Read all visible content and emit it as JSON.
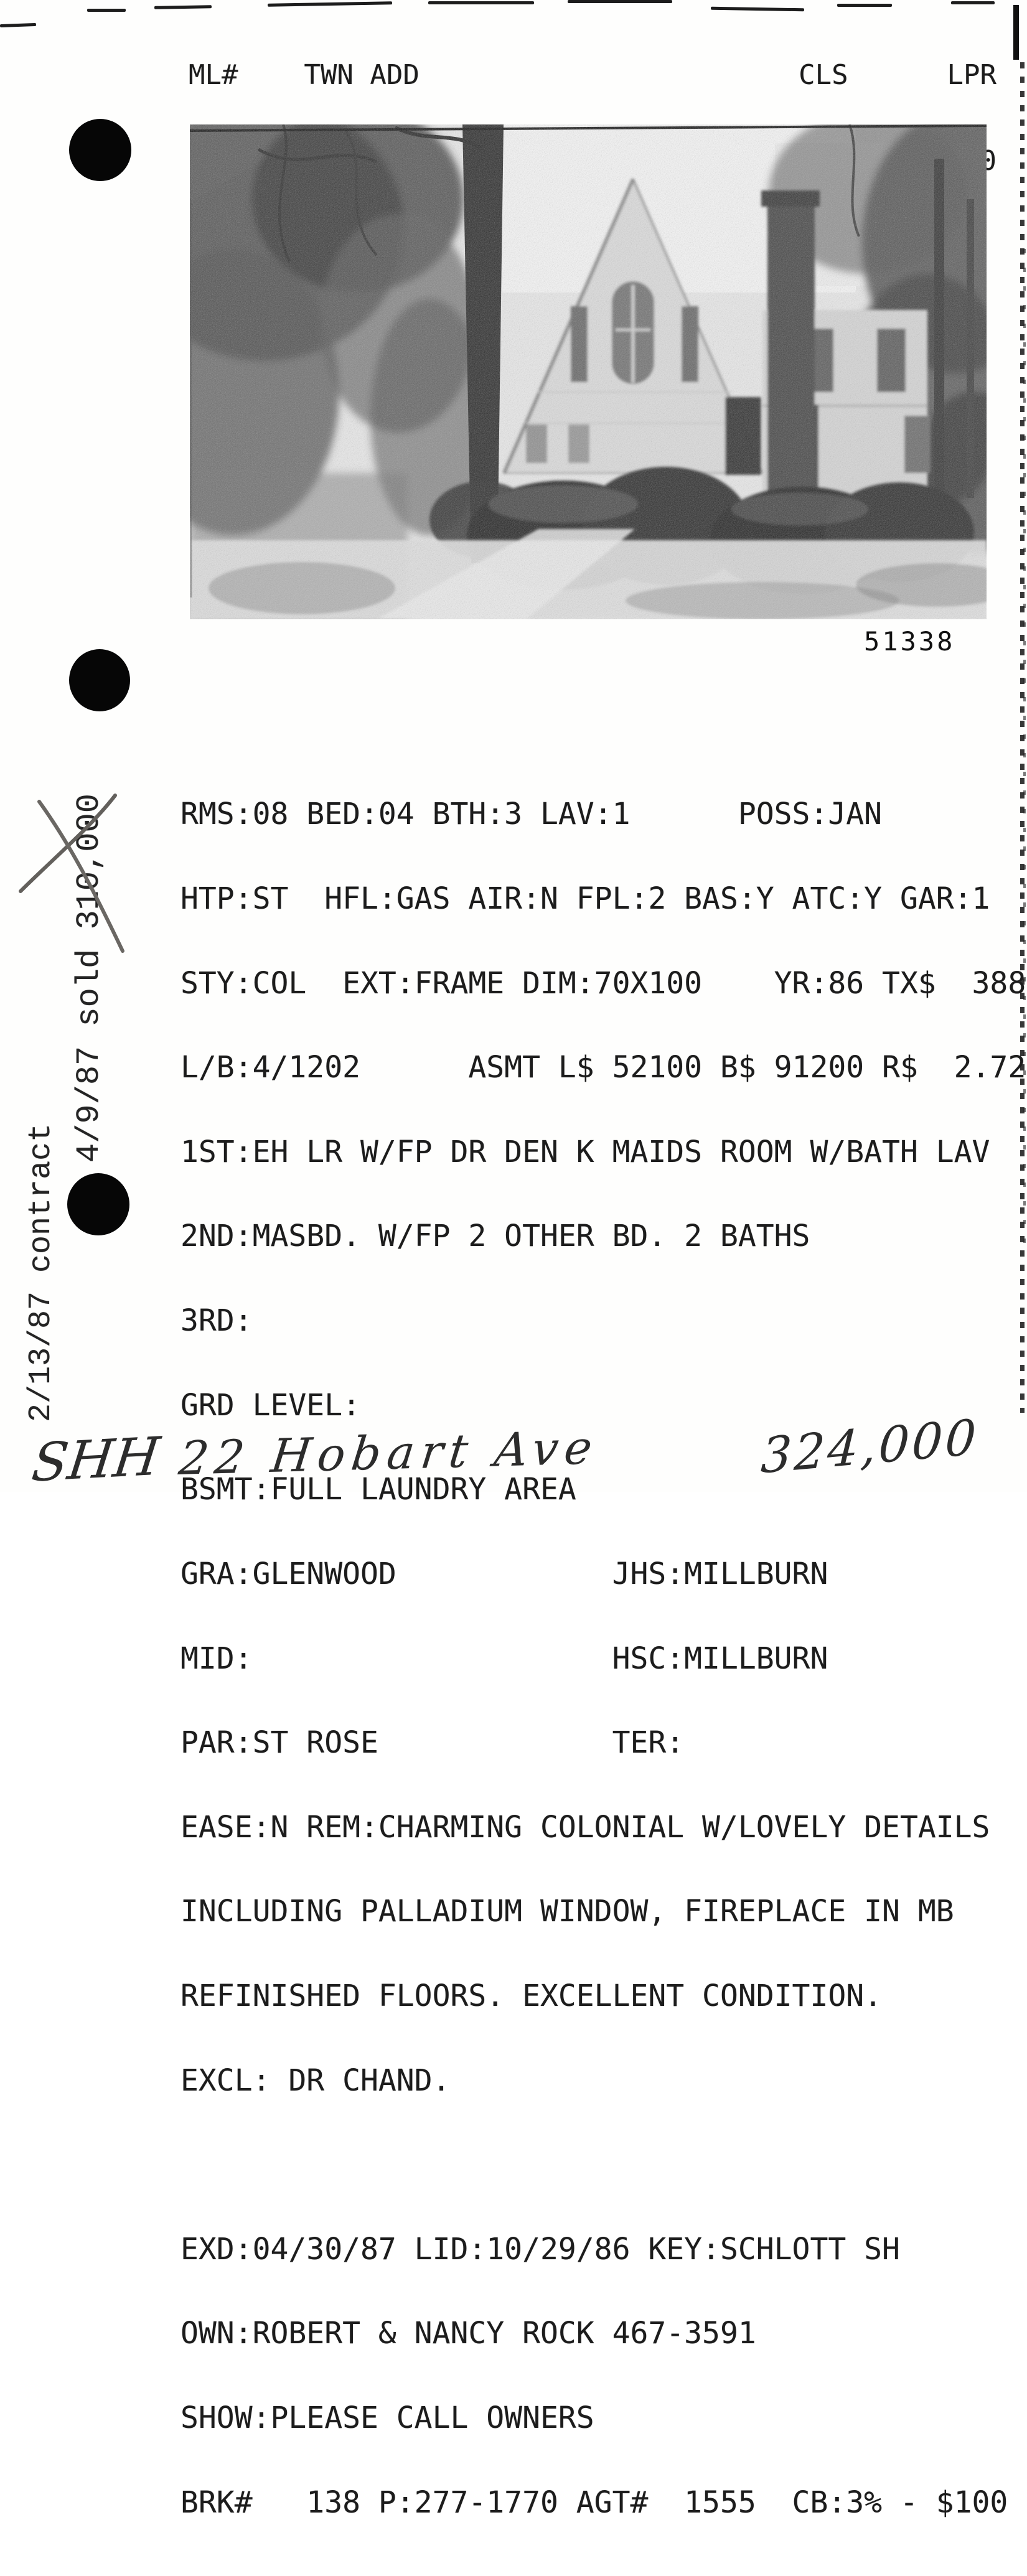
{
  "header": {
    "line1": "ML#    TWN ADD                       CLS      LPR",
    "line2": "51338 SHH 22 HOBART AVE              RES   324000"
  },
  "photo": {
    "id_label": "51338"
  },
  "listing": {
    "lines": [
      "RMS:08 BED:04 BTH:3 LAV:1      POSS:JAN",
      "HTP:ST  HFL:GAS AIR:N FPL:2 BAS:Y ATC:Y GAR:1",
      "STY:COL  EXT:FRAME DIM:70X100    YR:86 TX$  3889",
      "L/B:4/1202      ASMT L$ 52100 B$ 91200 R$  2.72",
      "1ST:EH LR W/FP DR DEN K MAIDS ROOM W/BATH LAV",
      "2ND:MASBD. W/FP 2 OTHER BD. 2 BATHS",
      "3RD:",
      "GRD LEVEL:",
      "BSMT:FULL LAUNDRY AREA",
      "GRA:GLENWOOD            JHS:MILLBURN",
      "MID:                    HSC:MILLBURN",
      "PAR:ST ROSE             TER:",
      "EASE:N REM:CHARMING COLONIAL W/LOVELY DETAILS",
      "INCLUDING PALLADIUM WINDOW, FIREPLACE IN MB",
      "REFINISHED FLOORS. EXCELLENT CONDITION.",
      "EXCL: DR CHAND.",
      "",
      "EXD:04/30/87 LID:10/29/86 KEY:SCHLOTT SH",
      "OWN:ROBERT & NANCY ROCK 467-3591",
      "SHOW:PLEASE CALL OWNERS",
      "BRK#   138 P:277-1770 AGT#  1555  CB:3% - $100"
    ]
  },
  "annotations": {
    "contract_note": "2/13/87 contract",
    "sold_note": "4/9/87 sold 310,000"
  },
  "handwriting": {
    "area_code": "SHH",
    "address": "22 Hobart Ave",
    "price": "324,000"
  },
  "colors": {
    "ink": "#1c1c1c",
    "pen_strike": "#63605c",
    "paper": "#fefefd"
  }
}
